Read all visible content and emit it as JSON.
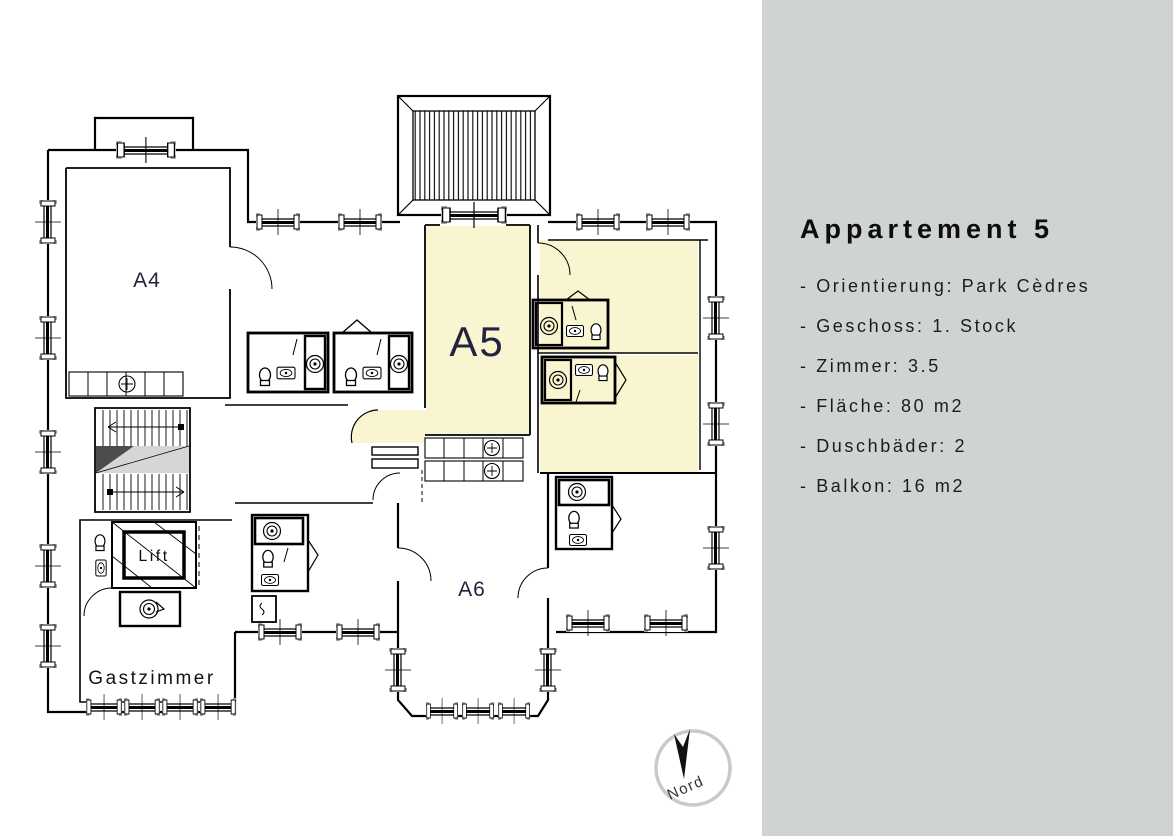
{
  "panel": {
    "title": "Appartement 5",
    "background_color": "#d0d3d4",
    "text_color": "#1c1c1c",
    "items": [
      {
        "text": "- Orientierung: Park Cèdres",
        "label": "Orientierung",
        "value": "Park Cèdres"
      },
      {
        "text": "- Geschoss: 1. Stock",
        "label": "Geschoss",
        "value": "1. Stock"
      },
      {
        "text": "- Zimmer: 3.5",
        "label": "Zimmer",
        "value": "3.5"
      },
      {
        "text": "- Fläche: 80 m2",
        "label": "Fläche",
        "value": "80 m2"
      },
      {
        "text": "- Duschbäder: 2",
        "label": "Duschbäder",
        "value": "2"
      },
      {
        "text": "- Balkon: 16 m2",
        "label": "Balkon",
        "value": "16 m2"
      }
    ]
  },
  "floorplan": {
    "highlighted_apartment": "A5",
    "highlight_color": "#f8f5d0",
    "room_label_color": "#23233f",
    "labels": {
      "a4": "A4",
      "a5": "A5",
      "a6": "A6",
      "lift": "Lift",
      "gastzimmer": "Gastzimmer"
    },
    "compass_label": "Nord"
  }
}
